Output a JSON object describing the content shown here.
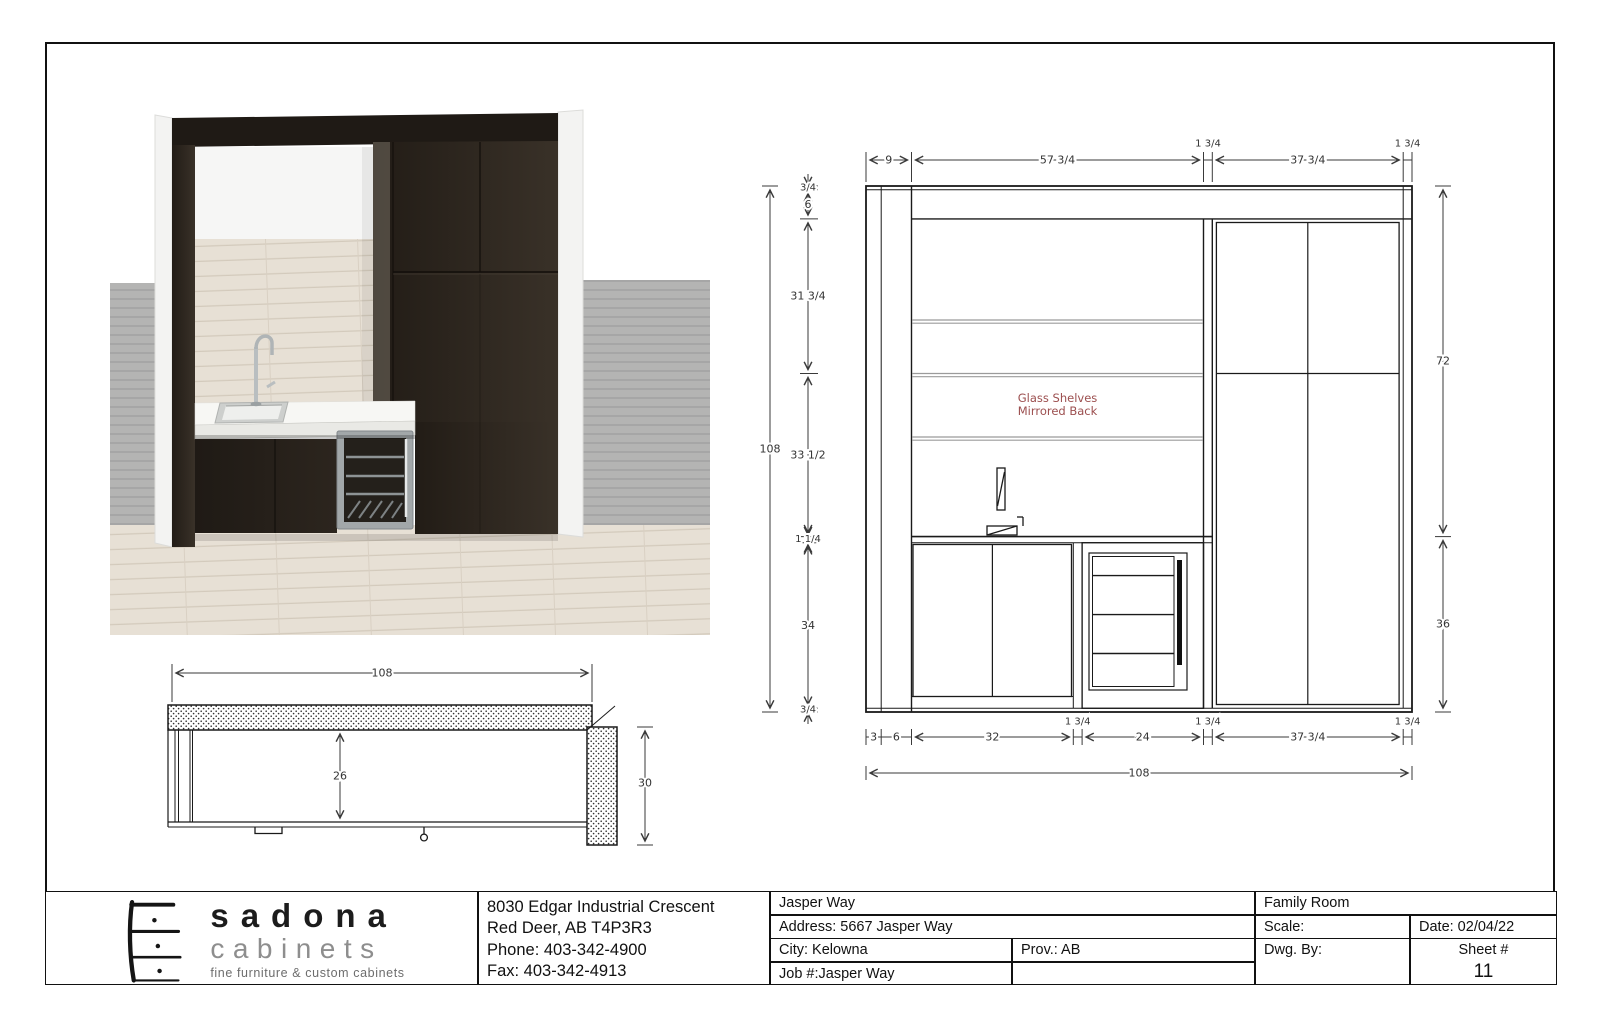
{
  "logo": {
    "name": "sadona",
    "word2": "cabinets",
    "tagline": "fine furniture & custom cabinets"
  },
  "company": {
    "line1": "8030 Edgar Industrial Crescent",
    "line2": "Red Deer, AB  T4P3R3",
    "line3": "Phone: 403-342-4900",
    "line4": "Fax: 403-342-4913"
  },
  "titleblock": {
    "project": "Jasper Way",
    "address": "Address: 5667 Jasper Way",
    "city": "City: Kelowna",
    "prov": "Prov.: AB",
    "job": "Job #:Jasper Way",
    "room": "Family Room",
    "scale": "Scale:",
    "date": "Date:  02/04/22",
    "dwg_by": "Dwg. By:",
    "sheet_label": "Sheet #",
    "sheet_number": "11"
  },
  "elevation": {
    "note1": "Glass Shelves",
    "note2": "Mirrored Back",
    "top": {
      "d0": "9",
      "d1": "57 3/4",
      "d2": "1 3/4",
      "d3": "37 3/4",
      "d4": "1 3/4"
    },
    "left": {
      "overall": "108",
      "d0": "3/4",
      "d1": "6",
      "d2": "31 3/4",
      "d3": "33 1/2",
      "d4": "1 1/4",
      "d5": "34",
      "d6": "3/4"
    },
    "right": {
      "d0": "72",
      "d1": "36"
    },
    "bottom": {
      "overall": "108",
      "d0": "3",
      "d1": "6",
      "d2": "32",
      "d3": "1 3/4",
      "d4": "24",
      "d5": "1 3/4",
      "d6": "37 3/4",
      "d7": "1 3/4"
    }
  },
  "plan": {
    "width": "108",
    "depth": "26",
    "height": "30"
  }
}
